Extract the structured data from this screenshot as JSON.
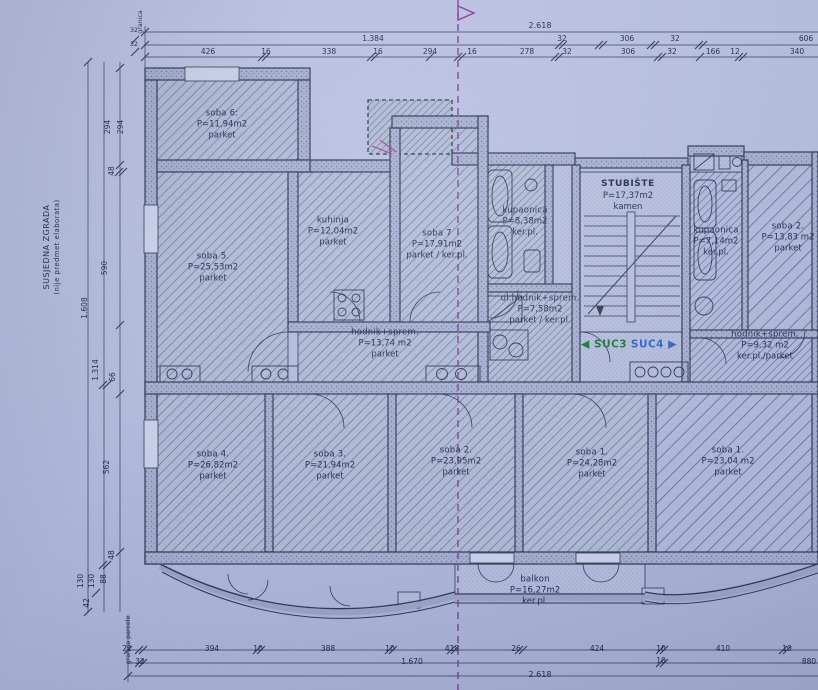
{
  "title": "Floor plan (tlocrt) with units SUC3 and SUC4",
  "boundary": {
    "top_label": "granica",
    "bottom_label": "granica parcele"
  },
  "side_building": {
    "line1": "SUSJEDNA ZGRADA",
    "line2": "(nije predmet elaborata)"
  },
  "units": {
    "suc3": "SUC3",
    "suc4": "SUC4"
  },
  "rooms": [
    {
      "name": "soba 6:",
      "area": "P=11,94m2",
      "floor": "parket"
    },
    {
      "name": "soba 5.",
      "area": "P=25,53m2",
      "floor": "parket"
    },
    {
      "name": "kuhinja",
      "area": "P=12,04m2",
      "floor": "parket"
    },
    {
      "name": "soba 7",
      "area": "P=17,91m2",
      "floor": "parket / ker.pl."
    },
    {
      "name": "kupaonica",
      "area": "P=8,38m2",
      "floor": "ker.pl."
    },
    {
      "name": "ul.hodnik+sprem.",
      "area": "P=7,58m2",
      "floor": "parket / ker.pl."
    },
    {
      "name": "hodnik+sprem.",
      "area": "P=13,74 m2",
      "floor": "parket"
    },
    {
      "name": "STUBIŠTE",
      "area": "P=17,37m2",
      "floor": "kamen"
    },
    {
      "name": "kupaonica",
      "area": "P=7,14m2",
      "floor": "ker.pl."
    },
    {
      "name": "soba 2.",
      "area": "P=13,83 m2",
      "floor": "parket"
    },
    {
      "name": "hodnik+sprem.",
      "area": "P=9,32 m2",
      "floor": "ker.pl./parket"
    },
    {
      "name": "soba 4.",
      "area": "P=26,82m2",
      "floor": "parket"
    },
    {
      "name": "soba 3.",
      "area": "P=21,94m2",
      "floor": "parket"
    },
    {
      "name": "soba 2.",
      "area": "P=23,95m2",
      "floor": "parket"
    },
    {
      "name": "soba 1.",
      "area": "P=24,28m2",
      "floor": "parket"
    },
    {
      "name": "soba 1.",
      "area": "P=23,04 m2",
      "floor": "parket"
    },
    {
      "name": "balkon",
      "area": "P=16,27m2",
      "floor": "ker.pl."
    }
  ],
  "dims": {
    "top_total": "2.618",
    "top_row2": [
      "1.384",
      "32",
      "306",
      "32",
      "606"
    ],
    "top_row3": [
      "426",
      "16",
      "338",
      "16",
      "294",
      "16",
      "278",
      "32",
      "306",
      "32",
      "166",
      "12",
      "340"
    ],
    "top_left": [
      "32",
      "32"
    ],
    "left": [
      "294",
      "294",
      "48",
      "590",
      "1.608",
      "1.314",
      "66",
      "562",
      "48",
      "88",
      "130",
      "130",
      "42"
    ],
    "bottom_row1": [
      "22",
      "394",
      "10",
      "388",
      "10",
      "418",
      "26",
      "424",
      "10",
      "410",
      "10"
    ],
    "bottom_row2": [
      "32",
      "1.670",
      "10",
      "880"
    ],
    "bottom_total": "2.618"
  },
  "colors": {
    "paper": "#b7c0e0",
    "ink": "#2e3954",
    "hatch_green": "#4a7a60",
    "hatch_blue": "#44618e",
    "suc3_green": "#157a33",
    "suc4_blue": "#2f62c8",
    "boundary_purple": "#8b3aa0"
  }
}
